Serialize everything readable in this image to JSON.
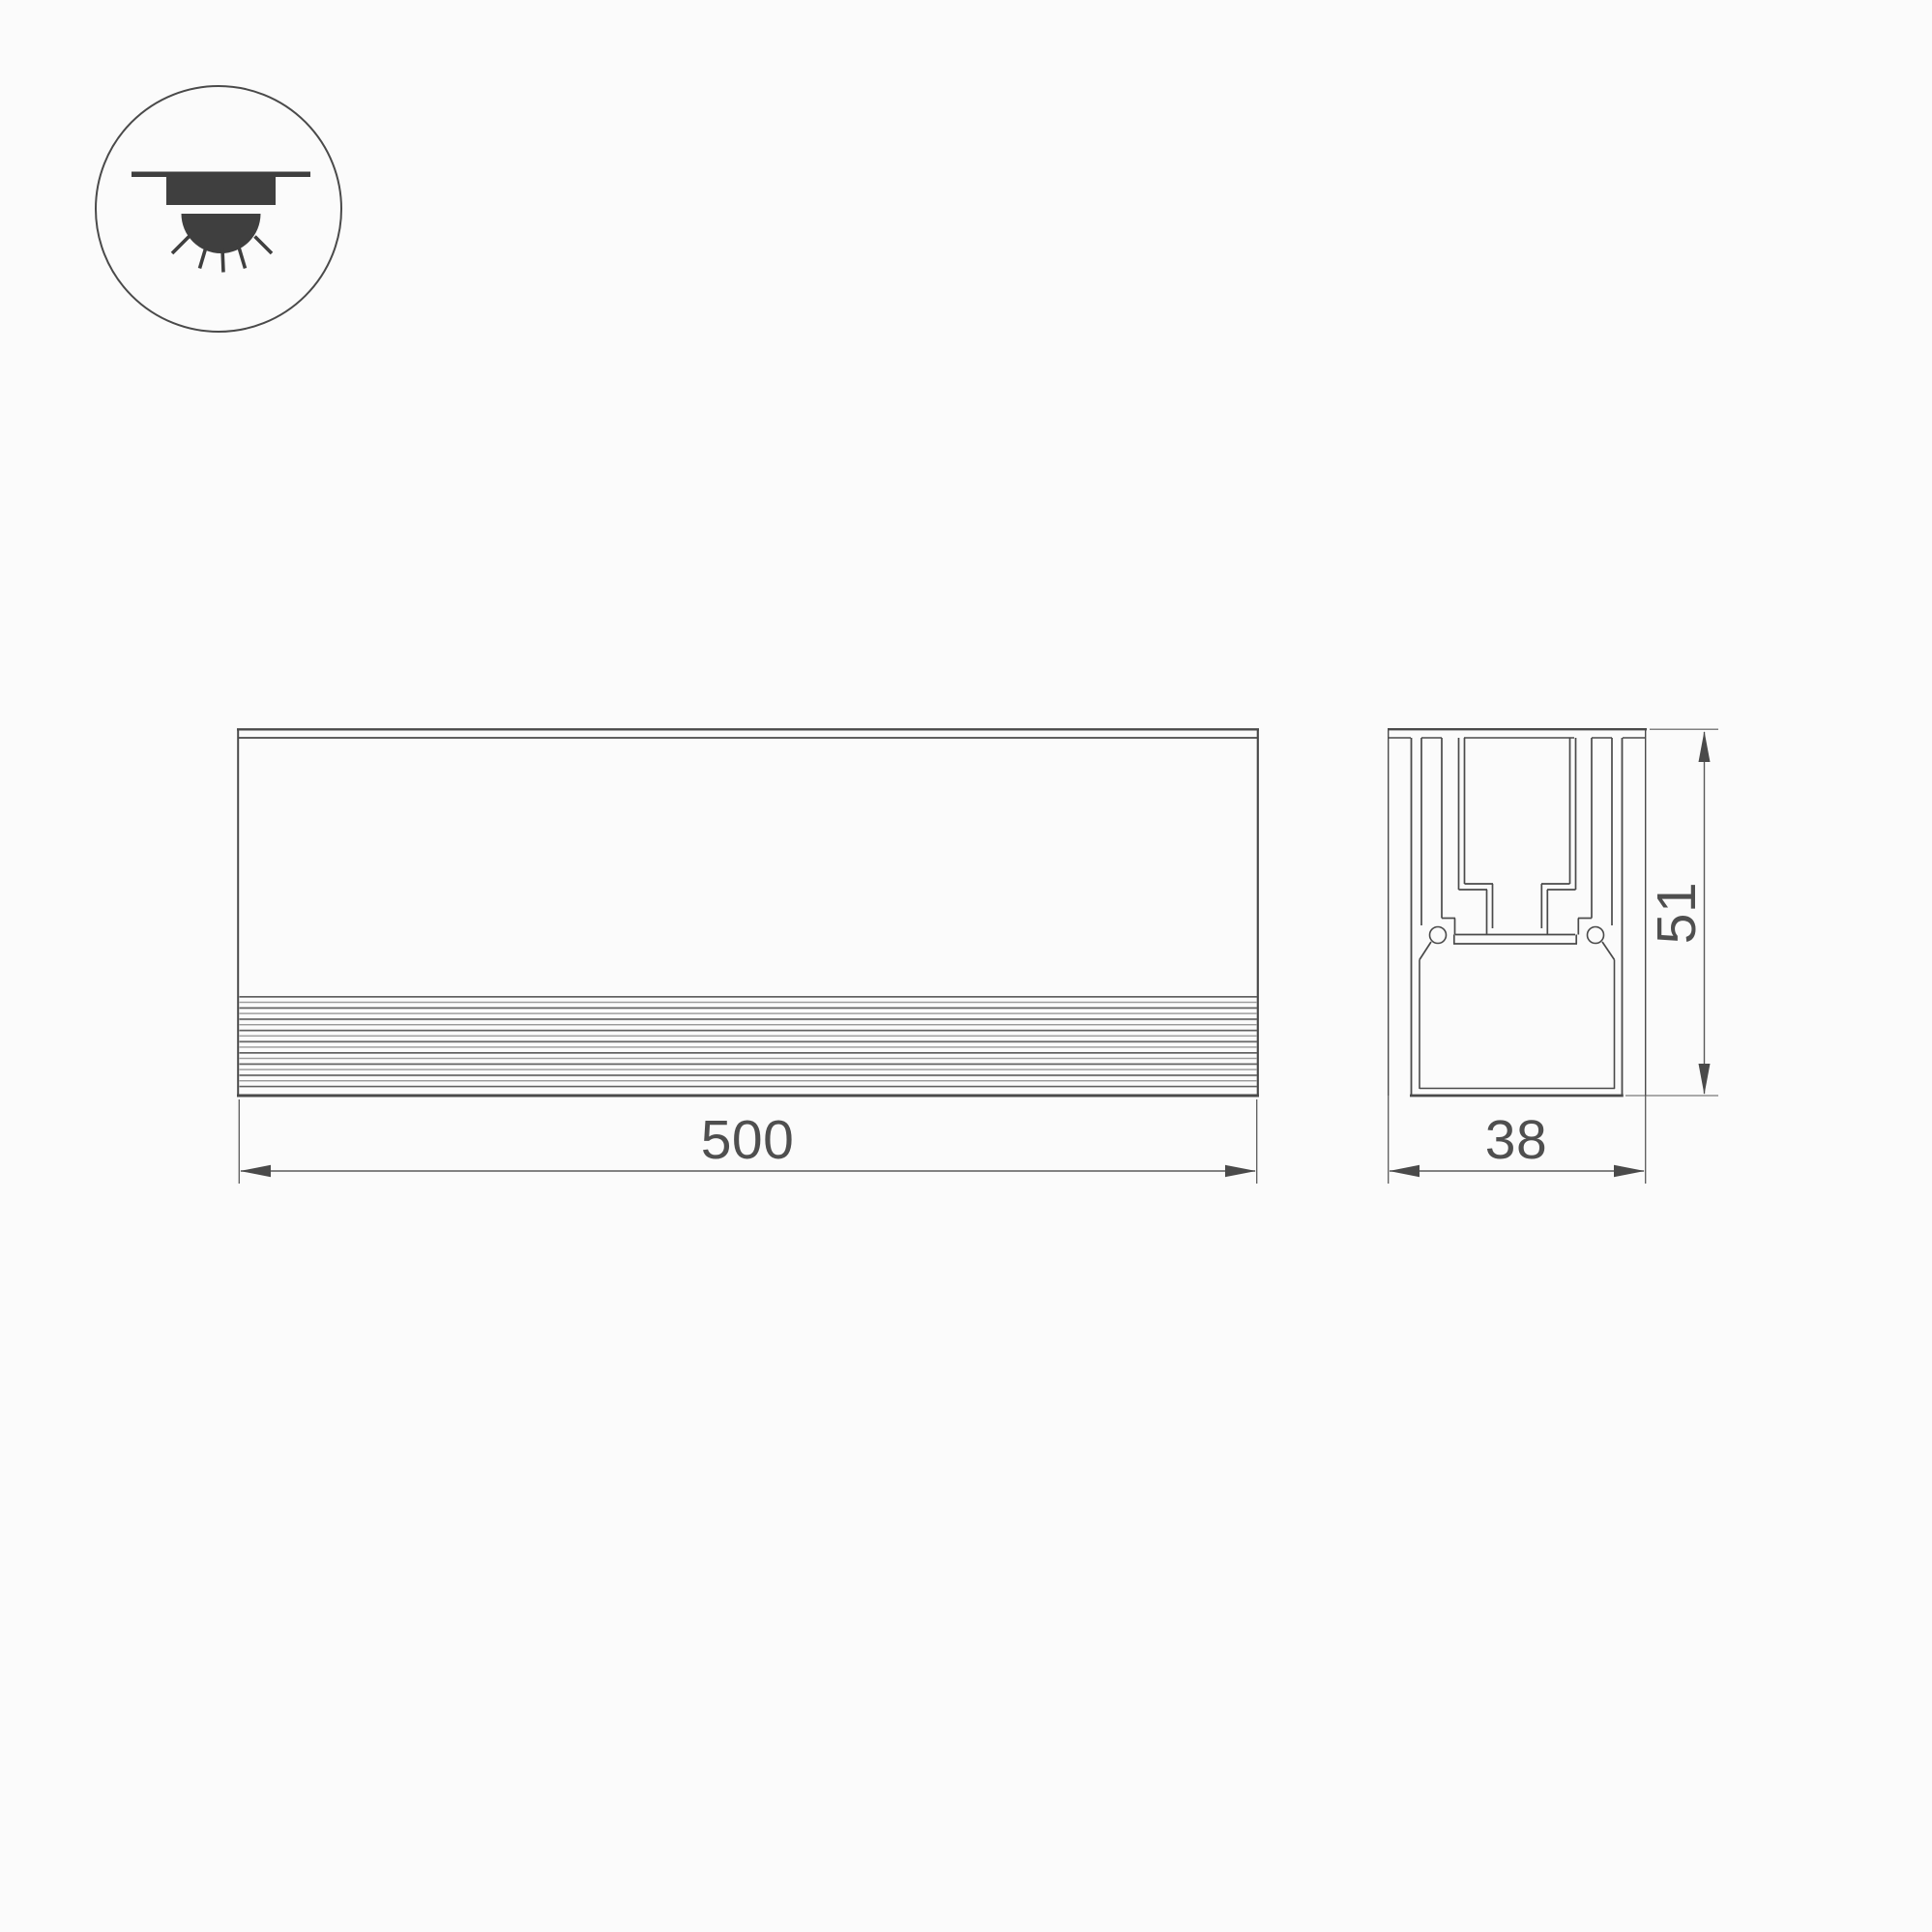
{
  "page": {
    "background": "#fbfbfb",
    "line_color": "#4a4a4a",
    "text_color": "#4f4f4f",
    "description": "technical dimension drawing of recessed linear luminaire profile"
  },
  "icon": {
    "name": "recessed-downlight-icon",
    "fill": "#3f3f3f"
  },
  "views": {
    "front_view": "front elevation with striped diffuser band",
    "section_view": "cross-section of mounting profile and lamp body"
  },
  "dimensions": {
    "length": "500",
    "width": "38",
    "height": "51"
  }
}
